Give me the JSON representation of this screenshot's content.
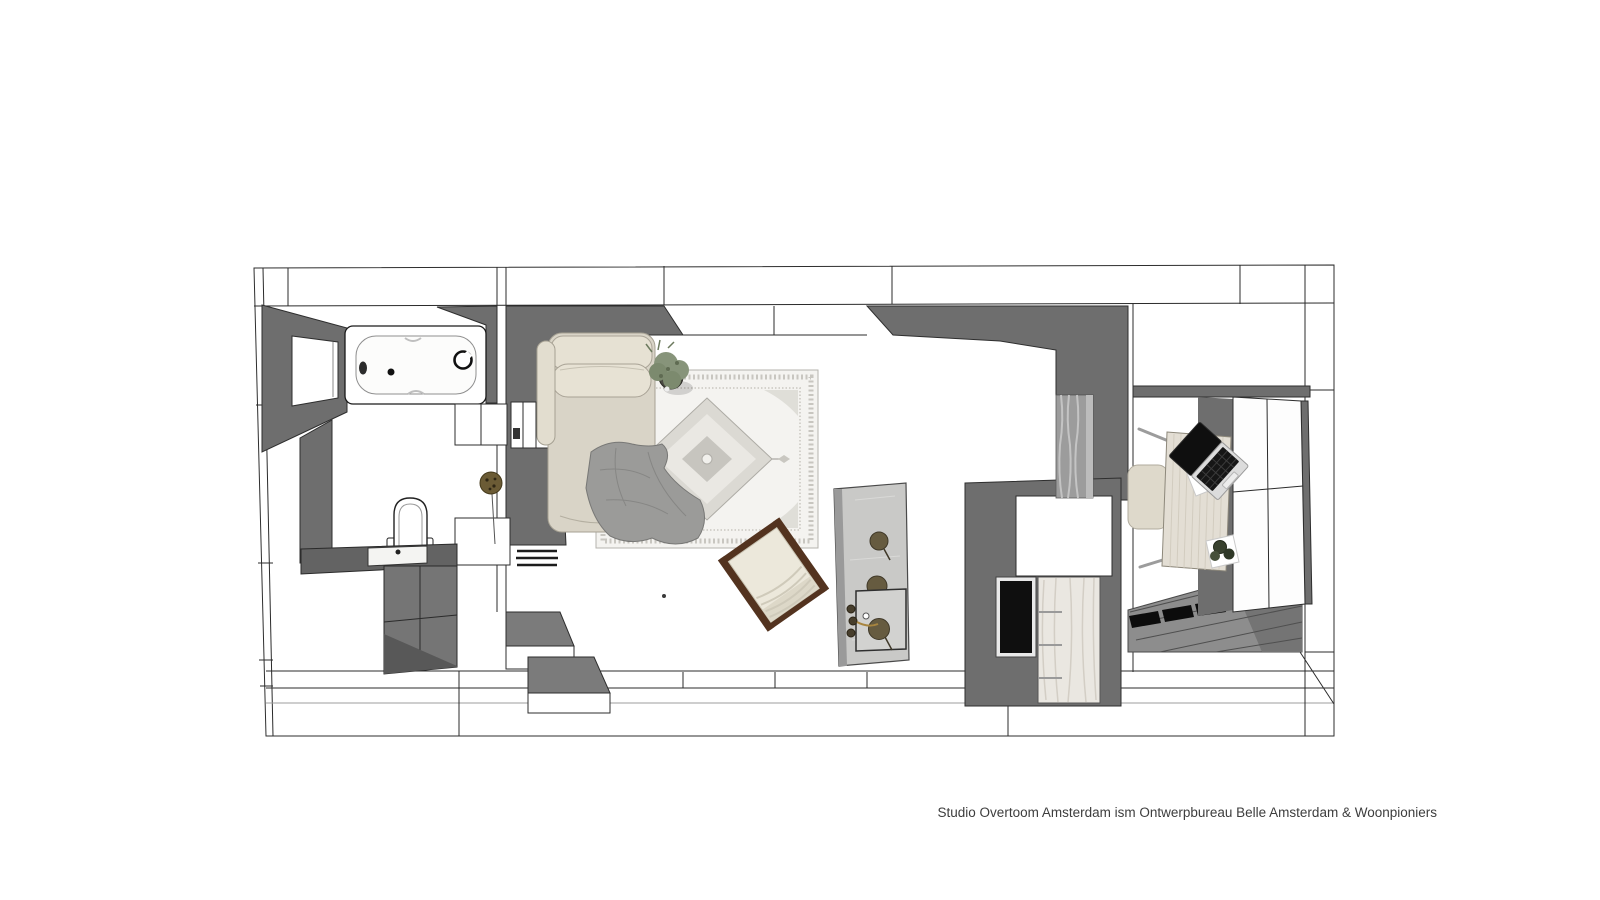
{
  "caption": {
    "credit": "Studio Overtoom Amsterdam ism Ontwerpbureau Belle Amsterdam & Woonpioniers"
  },
  "palette": {
    "wall": "#6e6e6e",
    "wall-mid": "#7b7b7b",
    "wall-dark": "#585858",
    "line": "#2b2b2b",
    "paper": "#ffffff",
    "concrete": "#c9c9c7",
    "sofa": "#d9d4c7",
    "sofa-light": "#e6e1d3",
    "blanket": "#9b9b99",
    "rug": "#f4f3f0",
    "rug-mid": "#dbd9d3",
    "rug-dark": "#c7c5bf",
    "wood": "#53331f",
    "cushion": "#ece8db",
    "marble": "#eae7e1",
    "desk": "#e3ded4",
    "laptop": "#0f0f0f",
    "plant": "#87947a",
    "pot": "#4a4a42",
    "pom": "#665b40",
    "floorwood": "#8d8d8d",
    "mat": "#0c0c0c",
    "curtain": "#9c9c9c",
    "text": "#3d3d3d"
  },
  "scene": {
    "type": "floor-plan-top-view",
    "elements": [
      "bathtub",
      "toilet",
      "vanity-sink",
      "dried-flowers",
      "wall-niche",
      "daybed",
      "throw-blanket",
      "persian-rug",
      "potted-plant",
      "rocking-chair",
      "steps",
      "kitchen-island",
      "island-sink",
      "tall-cabinet",
      "oven-glass",
      "marble-panel",
      "curtain",
      "desk",
      "laptop",
      "paper-sheet",
      "desk-plant",
      "desk-chair",
      "wardrobe",
      "plank-floor",
      "floor-mats"
    ]
  }
}
